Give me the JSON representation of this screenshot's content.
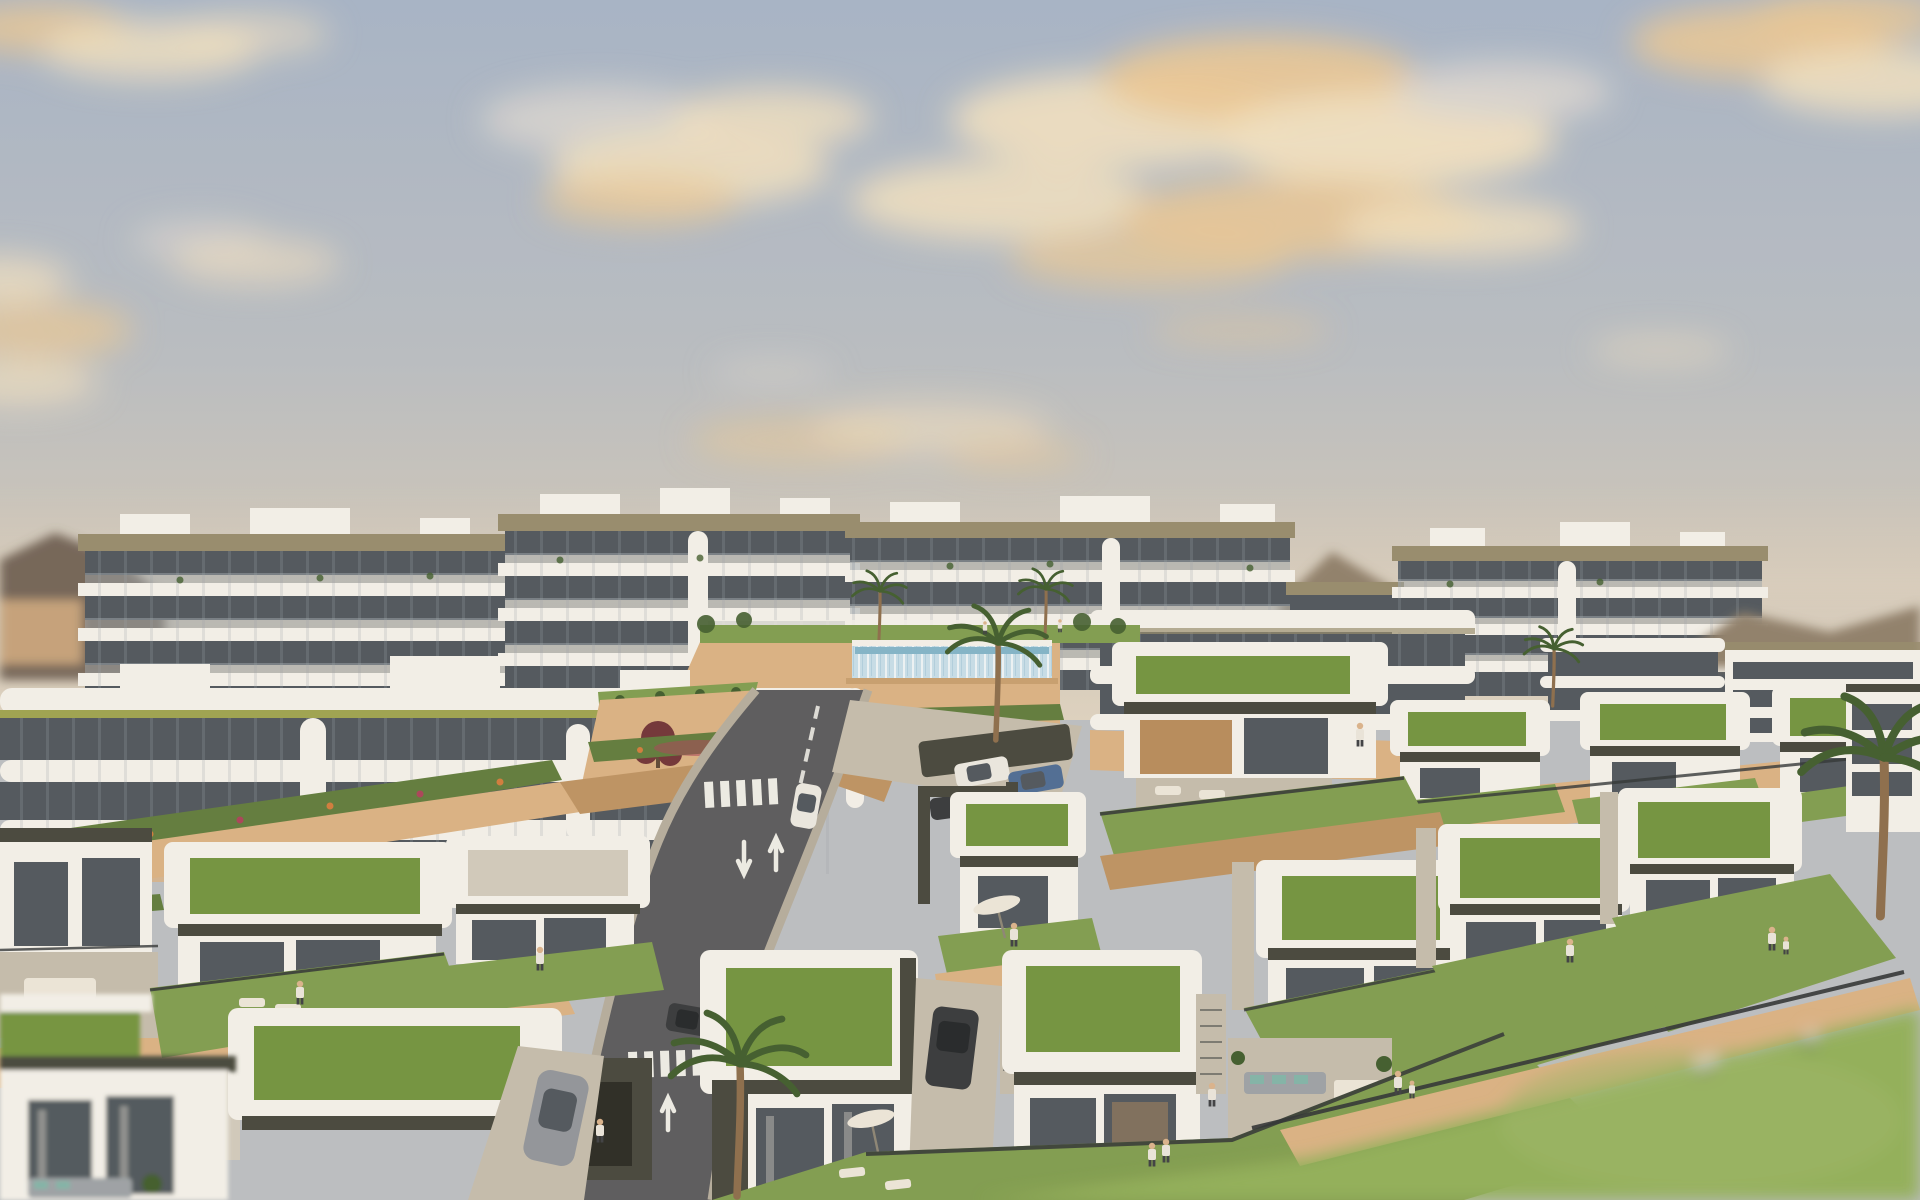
{
  "image": {
    "alt": "Aerial 3D architectural rendering of a hillside coastal residential development at golden hour: white multi-storey apartment blocks with tiered balconies and olive fascias rise behind terraced sandstone retaining walls, a glass-walled infinity pool, and rows of modern single-storey villas with white parapets and planted green roofs. A two-lane asphalt road with white arrow markings and crosswalks winds downhill between landscaped lawns with palm trees, parked cars, sun loungers, parasols and small figures of residents under a soft blue sky with warm sunset clouds.",
    "width": 1920,
    "height": 1200
  },
  "palette": {
    "sky-top": "#a4b3c8",
    "sky-mid": "#b7bcc2",
    "sky-low": "#ccc5ba",
    "sky-horizon": "#dcd1c0",
    "cloud-cream": "#f0e0c1",
    "cloud-amber": "#eac794",
    "cloud-grey": "#dad6d2",
    "hill-dark": "#6f6257",
    "hill-far": "#8d7e6a",
    "hill-green": "#7a7a5e",
    "bldg-white": "#f2f0ea",
    "bldg-shade": "#d8d3c8",
    "fascia-olive": "#948a6c",
    "stripe-green": "#9ba24f",
    "glass-dark": "#4c545c",
    "glass-warm": "#b5895a",
    "railing": "#9aa3ab",
    "stone-lit": "#d8b083",
    "stone-shade": "#bb9161",
    "planter-green": "#5d7a3c",
    "grass-roof": "#6f923e",
    "lawn": "#7d9b4e",
    "lawn-bright": "#8fae58",
    "road-asphalt": "#57585c",
    "road-mark": "#ebebe6",
    "sidewalk": "#b3ab9c",
    "concrete": "#c2bbac",
    "gravel": "#cfc9bc",
    "villa-dark": "#43443b",
    "fence-dark": "#2c3134",
    "pool-glass": "#c5dde9",
    "pool-water": "#7fb3c9",
    "white-furniture": "#eae5da",
    "car-white": "#e9e7e1",
    "car-grey": "#8f939a",
    "car-dark": "#33363a",
    "car-blue": "#4a6a94",
    "palm-green": "#3d5a2c",
    "trunk-brown": "#8a6b4a",
    "flower-red": "#a84058",
    "flower-orange": "#cf7a3a",
    "tree-burgundy": "#6e3136",
    "sofa-grey": "#9aa0a6",
    "cushion-teal": "#7fb3a8",
    "skin": "#d9b28c",
    "shirt": "#e8e4dc",
    "pants": "#3a3d42"
  },
  "scene": {
    "sky": {
      "cloud_clusters": 8
    },
    "background": {
      "hills": 3,
      "apartment_blocks": 5
    },
    "midground": {
      "terrace_buildings": 3,
      "pools": 1,
      "retaining_walls": "sandstone"
    },
    "road": {
      "lanes": 2,
      "crosswalks": 2,
      "lane_arrows": 4,
      "cars_moving": 2
    },
    "parking": {
      "cars_parked": 3
    },
    "villas": {
      "count": 14,
      "green_roofs": 13,
      "garages": 2
    },
    "vehicles": {
      "total_cars": 7,
      "suv": 1,
      "sports_car": 1
    },
    "people": 18,
    "palm_trees": 6,
    "furniture": {
      "sun_loungers": 10,
      "parasols": 2,
      "outdoor_sofas": 4,
      "dining_sets": 2
    }
  }
}
